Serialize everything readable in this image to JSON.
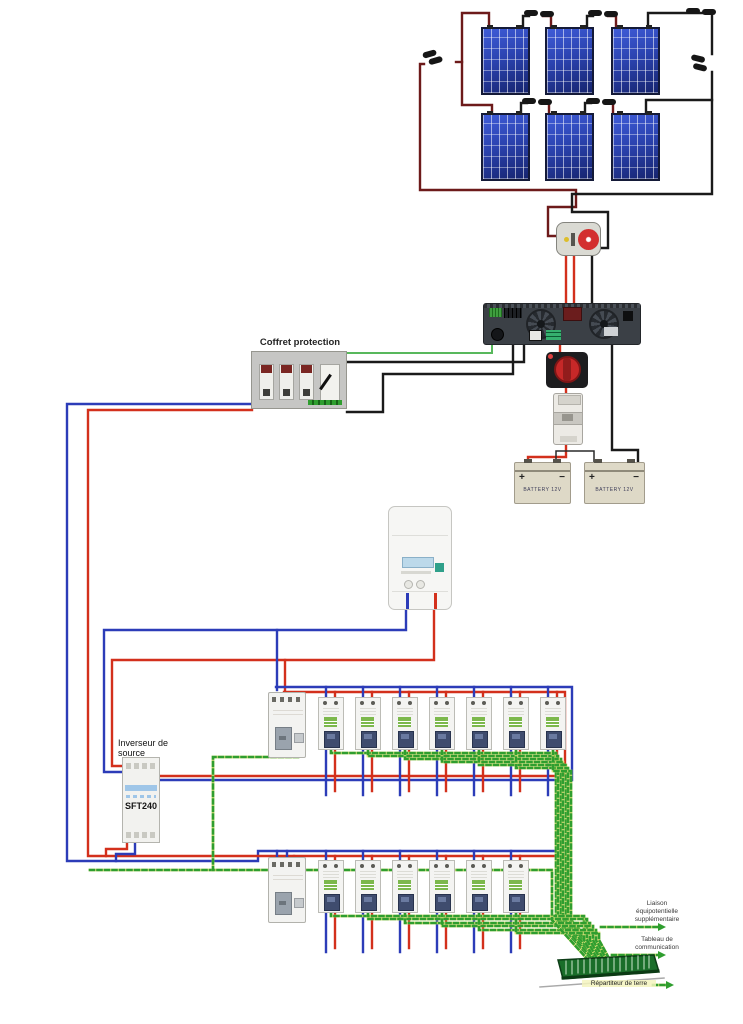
{
  "palette": {
    "pv_wire": "#6d1a1a",
    "black_wire": "#1a1a1a",
    "red_wire": "#d3301c",
    "blue_wire": "#2c3cb8",
    "green_wire": "#58b85c",
    "earth_yellow": "#e3e37a",
    "earth_green": "#2f9e2f",
    "panel_blue": "#2b43b0",
    "busbar_green": "#1a6e2a",
    "inverter_body": "#3b4046",
    "breaker_toggle": "#3f4c6e",
    "breaker_label_green": "#7cb84c",
    "rcd_toggle": "#9aa3ad",
    "battery_body": "#ded9c7",
    "switch_red": "#d32f2f",
    "meter_display": "#bcd9ea"
  },
  "labels": {
    "coffret": "Coffret protection",
    "inverseur_line1": "Inverseur de",
    "inverseur_line2": "source",
    "sft_model": "SFT240",
    "liaison_line1": "Liaison",
    "liaison_line2": "équipotentielle",
    "liaison_line3": "supplémentaire",
    "tableau_line1": "Tableau de",
    "tableau_line2": "communication",
    "repartiteur": "Répartiteur de terre",
    "battery_left": "BATTERY 12V",
    "battery_right": "BATTERY 12V",
    "battery_plus": "+",
    "battery_minus": "−"
  },
  "components": {
    "solar_panels": {
      "rows": 2,
      "per_row": 3,
      "total": 6
    },
    "row1": {
      "rcd_count": 1,
      "breaker_count": 7
    },
    "row2": {
      "rcd_count": 1,
      "breaker_count": 6
    }
  }
}
